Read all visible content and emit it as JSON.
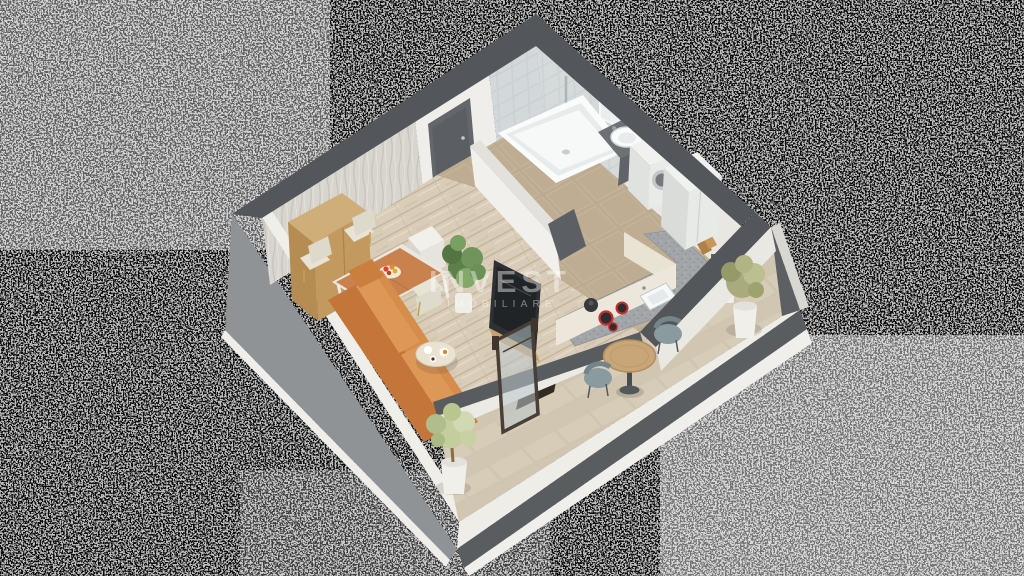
{
  "image": {
    "kind": "3d-floor-plan-render",
    "view": "isometric-top-down",
    "background": "tv-static-noise"
  },
  "watermark": {
    "title": "INVEST",
    "subtitle": "IMOBILIARE",
    "color": "#ffffff"
  },
  "palette": {
    "wall_top": "#54575a",
    "wall_outer": "#8f9396",
    "wall_inner": "#f2f1ed",
    "slab": "#f0efec",
    "wood_floor": "#d9ccb8",
    "hall_tile": "#bcab90",
    "balcony_tile": "#cfc5b1",
    "bath_wall_tile": "#cbd0d3",
    "counter": "#a2a6a8",
    "sofa": "#cd8041",
    "dining_table": "#c9824d",
    "chair": "#e7e4d6",
    "tv": "#2e3134",
    "plant": "#6f955a",
    "fixture_white": "#fafbfb",
    "door": "#63676b"
  },
  "rooms": [
    {
      "name": "living-dining",
      "items": [
        "wardrobe",
        "dining-table",
        "dining-chairs",
        "fruit-bowl",
        "sofa",
        "coffee-table",
        "tv-panel",
        "media-unit",
        "potted-plant"
      ]
    },
    {
      "name": "entry-hall",
      "items": [
        "entry-door",
        "hall-cabinet"
      ]
    },
    {
      "name": "bathroom",
      "items": [
        "bathtub",
        "vanity-sink",
        "mirror",
        "toilet",
        "washing-machine",
        "tiled-wall"
      ]
    },
    {
      "name": "kitchen",
      "items": [
        "fridge",
        "l-shaped-counter",
        "kitchen-sink",
        "stove",
        "kettle",
        "cutting-boards",
        "oil-bottles",
        "counter-plant"
      ]
    },
    {
      "name": "balcony",
      "items": [
        "bistro-table",
        "balcony-chairs",
        "potted-shrub",
        "small-tree",
        "glass-door"
      ]
    }
  ]
}
